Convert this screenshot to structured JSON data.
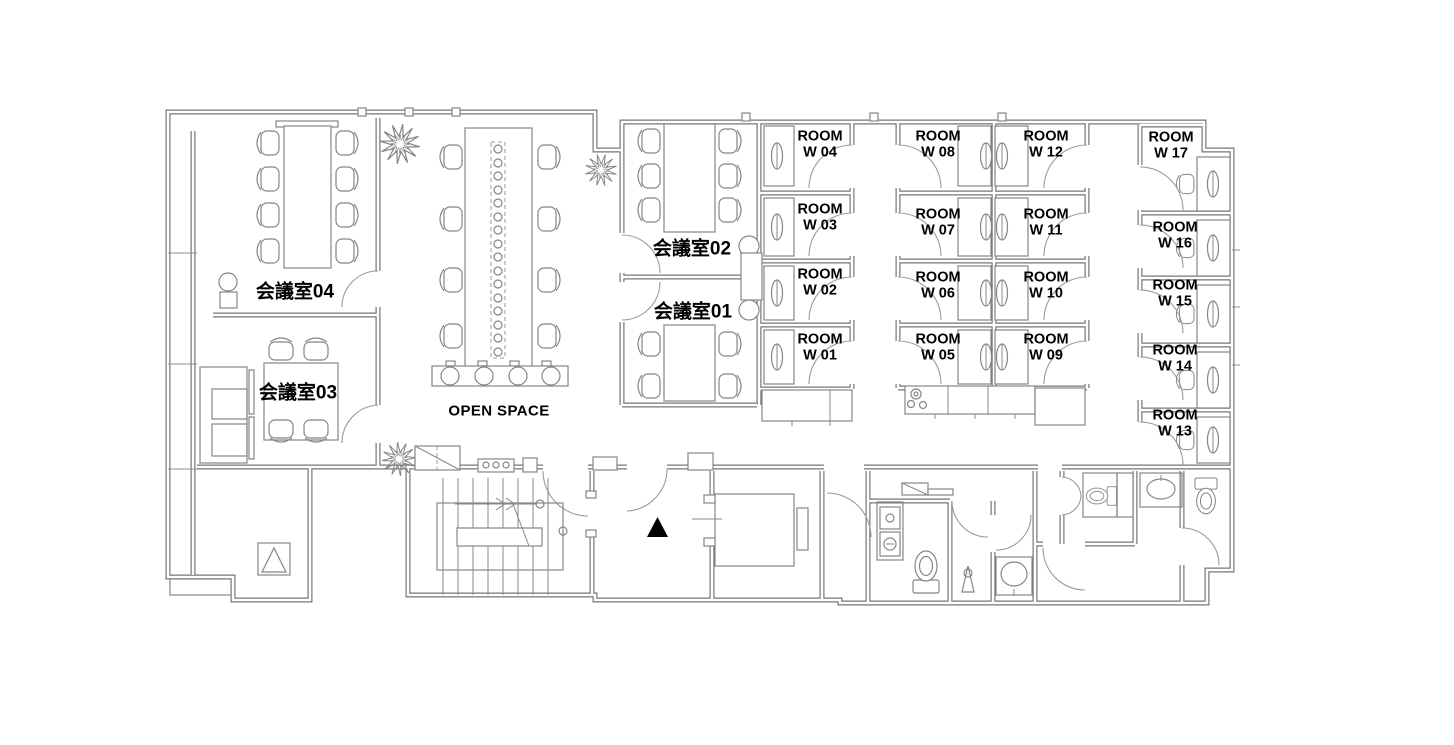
{
  "floorplan": {
    "open_space_label": "OPEN SPACE",
    "meeting_rooms": [
      {
        "id": "meeting-room-04",
        "label": "会議室04"
      },
      {
        "id": "meeting-room-03",
        "label": "会議室03"
      },
      {
        "id": "meeting-room-02",
        "label": "会議室02"
      },
      {
        "id": "meeting-room-01",
        "label": "会議室01"
      }
    ],
    "private_rooms": [
      {
        "id": "room-w01",
        "label": "ROOM\nW 01"
      },
      {
        "id": "room-w02",
        "label": "ROOM\nW 02"
      },
      {
        "id": "room-w03",
        "label": "ROOM\nW 03"
      },
      {
        "id": "room-w04",
        "label": "ROOM\nW 04"
      },
      {
        "id": "room-w05",
        "label": "ROOM\nW 05"
      },
      {
        "id": "room-w06",
        "label": "ROOM\nW 06"
      },
      {
        "id": "room-w07",
        "label": "ROOM\nW 07"
      },
      {
        "id": "room-w08",
        "label": "ROOM\nW 08"
      },
      {
        "id": "room-w09",
        "label": "ROOM\nW 09"
      },
      {
        "id": "room-w10",
        "label": "ROOM\nW 10"
      },
      {
        "id": "room-w11",
        "label": "ROOM\nW 11"
      },
      {
        "id": "room-w12",
        "label": "ROOM\nW 12"
      },
      {
        "id": "room-w13",
        "label": "ROOM\nW 13"
      },
      {
        "id": "room-w14",
        "label": "ROOM\nW 14"
      },
      {
        "id": "room-w15",
        "label": "ROOM\nW 15"
      },
      {
        "id": "room-w16",
        "label": "ROOM\nW 16"
      },
      {
        "id": "room-w17",
        "label": "ROOM\nW 17"
      }
    ]
  }
}
